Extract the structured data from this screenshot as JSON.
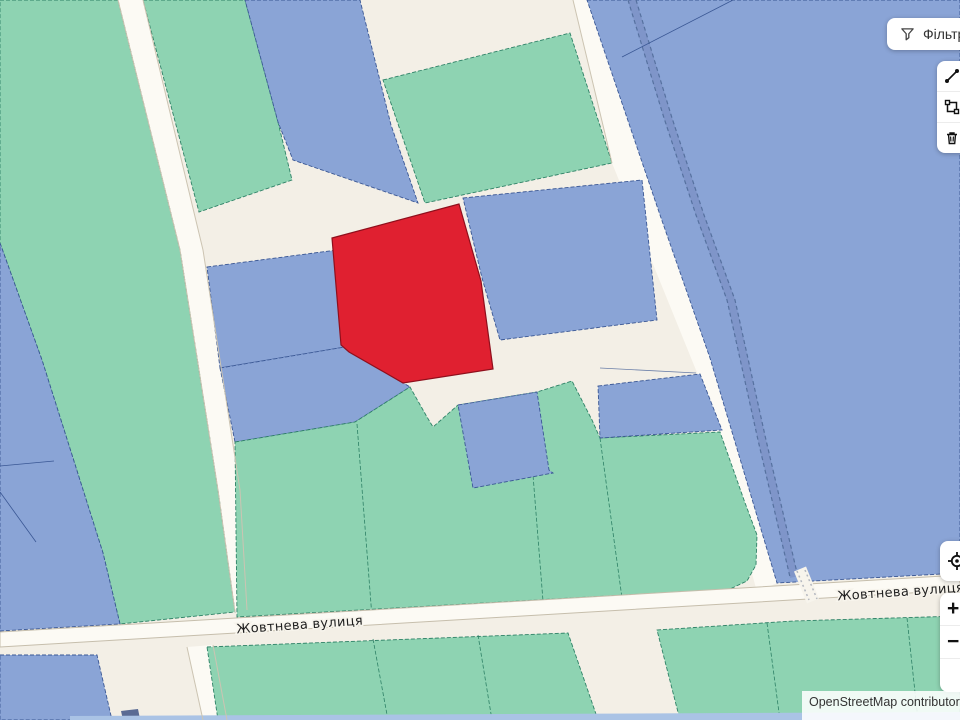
{
  "ui": {
    "filter_button": {
      "label": "Фільтр"
    },
    "map_controls": {
      "zoom_in": "+",
      "zoom_out": "−",
      "pan_up": "▲",
      "pan_down": "▼"
    },
    "attribution": "OpenStreetMap contributors"
  },
  "map": {
    "colors": {
      "bg": "#f3efe6",
      "teal_fill": "#8ed3b2",
      "teal_stroke": "#2e8166",
      "blue_fill": "#8aa4d6",
      "blue_stroke": "#3a5794",
      "red_fill": "#e02030",
      "red_stroke": "#8f0f1c",
      "road_fill": "#fcfaf4",
      "street_stroke": "#c6beac",
      "building_fill": "#5a6b94",
      "strip_fill": "#aac3e5"
    },
    "street_labels": [
      {
        "text": "Жовтнева вулиця",
        "x": 300,
        "y": 629,
        "rotation": -4
      },
      {
        "text": "Жовтнева вулиця",
        "x": 901,
        "y": 596,
        "rotation": -4
      }
    ],
    "shapes": [
      {
        "t": "polygon",
        "n": "road-strip-left",
        "k": "road",
        "i": false,
        "p": "118,0 143,0 203,250 240,490 247,610 235,612 218,490 180,250"
      },
      {
        "t": "polygon",
        "n": "road-strip-below",
        "k": "road",
        "i": false,
        "p": "187,647 213,645 227,720 203,720"
      },
      {
        "t": "polygon",
        "n": "road-strip-right",
        "k": "road",
        "i": false,
        "p": "573,0 587,0 660,215 710,358 777,583 757,592 700,380 612,163"
      },
      {
        "t": "polygon",
        "n": "parcel-green",
        "k": "teal",
        "i": true,
        "p": "0,0 118,0 180,250 218,490 235,612 120,624 103,553 42,360 0,243"
      },
      {
        "t": "polygon",
        "n": "parcel-blue",
        "k": "blue",
        "i": true,
        "p": "0,243 42,360 103,553 120,624 0,631"
      },
      {
        "t": "polyline",
        "n": "parcel-boundary",
        "i": false,
        "p": "0,466 54,461",
        "color": "#3a5794",
        "width": 0.8
      },
      {
        "t": "polyline",
        "n": "parcel-boundary",
        "i": false,
        "p": "0,492 36,542",
        "color": "#3a5794",
        "width": 0.8
      },
      {
        "t": "polygon",
        "n": "parcel-green",
        "k": "teal",
        "i": true,
        "p": "143,0 245,0 278,122 292,180 199,212"
      },
      {
        "t": "polygon",
        "n": "parcel-blue",
        "k": "blue",
        "i": true,
        "p": "245,0 360,0 391,125 418,203 293,160 278,122"
      },
      {
        "t": "polygon",
        "n": "parcel-green",
        "k": "teal",
        "i": true,
        "p": "383,80 570,33 612,163 425,203"
      },
      {
        "t": "polygon",
        "n": "parcel-blue-large",
        "k": "blue",
        "i": true,
        "p": "587,0 960,0 960,573 777,583 710,358 660,215"
      },
      {
        "t": "polyline",
        "n": "stream",
        "i": false,
        "p": "632,0 668,118 700,215 731,300 762,440 794,577",
        "color": "#7f95c9",
        "width": 8
      },
      {
        "t": "polyline",
        "n": "stream-edge",
        "i": false,
        "p": "628,0 664,118 696,215 727,300 758,440 790,577",
        "color": "#56719f",
        "width": 1.2,
        "dash": "4 3"
      },
      {
        "t": "polyline",
        "n": "stream-edge",
        "i": false,
        "p": "636,0 672,118 704,215 735,300 766,440 798,577",
        "color": "#56719f",
        "width": 1.2,
        "dash": "4 3"
      },
      {
        "t": "polyline",
        "n": "parcel-boundary",
        "i": false,
        "p": "733,0 622,57",
        "color": "#3a5794",
        "width": 0.8
      },
      {
        "t": "polygon",
        "n": "parcel-blue",
        "k": "blue",
        "i": true,
        "p": "207,267 337,250 345,347 220,368"
      },
      {
        "t": "polygon",
        "n": "parcel-blue",
        "k": "blue",
        "i": true,
        "p": "220,368 345,347 410,387 355,422 235,442"
      },
      {
        "t": "polygon",
        "n": "selected-parcel-red",
        "k": "red",
        "i": true,
        "p": "459,204 481,281 493,369 403,383 349,352 341,345 332,238"
      },
      {
        "t": "polygon",
        "n": "parcel-blue",
        "k": "blue",
        "i": true,
        "p": "463,198 642,180 657,320 500,340 482,278"
      },
      {
        "t": "polygon",
        "n": "parcel-green-large",
        "k": "teal",
        "i": true,
        "p": "235,442 355,422 410,387 427,417 433,427 458,405 537,392 572,381 592,420 600,438 720,432 744,500 757,535 756,565 747,581 730,589 237,617"
      },
      {
        "t": "polyline",
        "n": "parcel-boundary",
        "i": false,
        "p": "357,424 372,617",
        "color": "#2e8166",
        "width": 0.8,
        "dash": "4 2"
      },
      {
        "t": "polyline",
        "n": "parcel-boundary",
        "i": false,
        "p": "537,392 533,475 543,601",
        "color": "#2e8166",
        "width": 0.8,
        "dash": "4 2"
      },
      {
        "t": "polyline",
        "n": "parcel-boundary",
        "i": false,
        "p": "600,438 622,598",
        "color": "#2e8166",
        "width": 0.8,
        "dash": "4 2"
      },
      {
        "t": "polygon",
        "n": "parcel-blue",
        "k": "blue",
        "i": true,
        "p": "458,405 537,392 549,470 553,473 473,488"
      },
      {
        "t": "polygon",
        "n": "parcel-blue",
        "k": "blue",
        "i": true,
        "p": "598,386 700,374 722,430 600,438"
      },
      {
        "t": "polyline",
        "n": "parcel-boundary",
        "i": false,
        "p": "600,368 696,373",
        "color": "#6b7fa8",
        "width": 0.8
      },
      {
        "t": "polygon",
        "n": "street-zhovtneva",
        "k": "street",
        "i": false,
        "p": "0,632 960,575 960,590 0,647"
      },
      {
        "t": "polyline",
        "n": "crossing",
        "i": false,
        "p": "800,569 813,601",
        "color": "#f7f4ec",
        "width": 13
      },
      {
        "t": "polyline",
        "n": "crossing-dots",
        "i": false,
        "p": "797,571 809,600",
        "color": "#b3b7bf",
        "width": 1.5,
        "dash": "2 3"
      },
      {
        "t": "polyline",
        "n": "crossing-dots",
        "i": false,
        "p": "805,570 817,599",
        "color": "#b3b7bf",
        "width": 1.5,
        "dash": "2 3"
      },
      {
        "t": "polygon",
        "n": "parcel-blue",
        "k": "blue",
        "i": true,
        "p": "0,655 97,655 112,720 0,720"
      },
      {
        "t": "polygon",
        "n": "building",
        "k": "building",
        "i": false,
        "p": "121,711 138,709 140,719 123,720"
      },
      {
        "t": "polygon",
        "n": "parcel-green",
        "k": "teal",
        "i": true,
        "p": "207,647 568,633 597,717 600,720 218,720"
      },
      {
        "t": "polyline",
        "n": "parcel-boundary",
        "i": false,
        "p": "373,639 388,720",
        "color": "#2e8166",
        "width": 0.8,
        "dash": "4 2"
      },
      {
        "t": "polyline",
        "n": "parcel-boundary",
        "i": false,
        "p": "478,635 492,720",
        "color": "#2e8166",
        "width": 0.8,
        "dash": "4 2"
      },
      {
        "t": "polygon",
        "n": "parcel-green",
        "k": "teal",
        "i": true,
        "p": "657,630 793,621 960,616 960,720 680,720"
      },
      {
        "t": "polyline",
        "n": "parcel-boundary",
        "i": false,
        "p": "767,623 780,720",
        "color": "#2e8166",
        "width": 0.8,
        "dash": "4 2"
      },
      {
        "t": "polyline",
        "n": "parcel-boundary",
        "i": false,
        "p": "907,618 918,720",
        "color": "#2e8166",
        "width": 0.8,
        "dash": "4 2"
      },
      {
        "t": "polygon",
        "n": "water-strip",
        "k": "strip",
        "i": false,
        "p": "70,716 960,712 960,720 70,720"
      },
      {
        "t": "polyline",
        "n": "road-edge",
        "i": false,
        "p": "118,0 180,250 218,490 235,612",
        "color": "#ccc4b2",
        "width": 1
      },
      {
        "t": "polyline",
        "n": "road-edge",
        "i": false,
        "p": "143,0 203,250 240,490 247,610",
        "color": "#ccc4b2",
        "width": 1
      },
      {
        "t": "polyline",
        "n": "road-edge",
        "i": false,
        "p": "187,647 203,720",
        "color": "#ccc4b2",
        "width": 1
      },
      {
        "t": "polyline",
        "n": "road-edge",
        "i": false,
        "p": "213,645 227,720",
        "color": "#ccc4b2",
        "width": 1
      },
      {
        "t": "polyline",
        "n": "road-edge",
        "i": false,
        "p": "573,0 612,163",
        "color": "#ccc4b2",
        "width": 1
      }
    ]
  }
}
